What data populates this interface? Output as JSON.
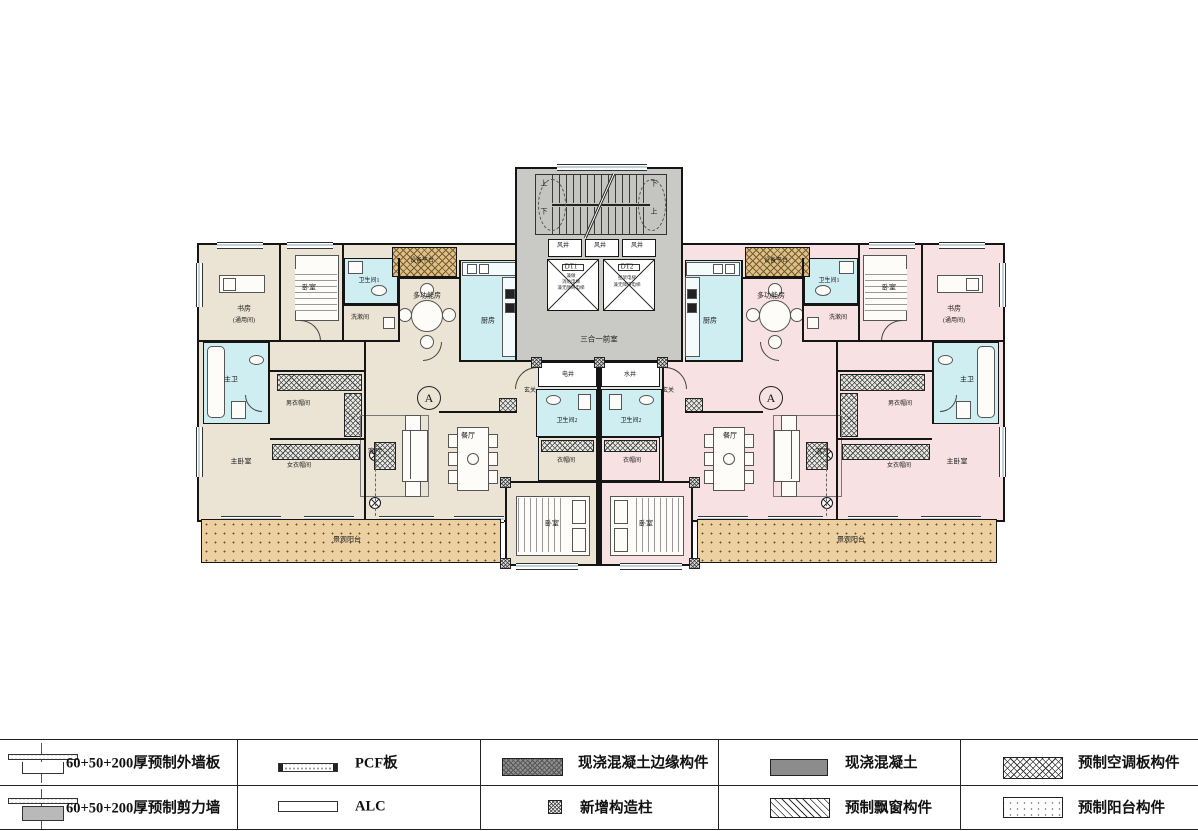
{
  "plan": {
    "marker_a": "A",
    "core": {
      "stair_up": "上",
      "stair_down": "下",
      "vent_shaft": "风井",
      "elevator1": "DT1",
      "elevator2": "DT2",
      "elevator1_note": [
        "兼做",
        "消防电梯",
        "兼无障碍电梯"
      ],
      "elevator2_note": [
        "担架电梯",
        "兼无障碍电梯"
      ],
      "lobby": "三合一前室",
      "electric_shaft": "电井",
      "water_shaft": "水井"
    },
    "rooms": {
      "study": "书房",
      "study_note": "(通用间)",
      "bedroom": "卧室",
      "bath1": "卫生间1",
      "laundry": "洗漱间",
      "multi_room": "多功能房",
      "kitchen": "厨房",
      "master_bath": "主卫",
      "mens_closet": "男衣帽间",
      "master_bedroom": "主卧室",
      "womens_closet": "女衣帽间",
      "living": "客厅",
      "dining": "餐厅",
      "foyer": "玄关",
      "bath2": "卫生间2",
      "closet": "衣帽间",
      "view_balcony": "景观阳台",
      "equipment_platform": "设备平台"
    }
  },
  "legend": {
    "items": [
      {
        "symbol": "precast-exterior-wall-panel",
        "label": "60+50+200厚预制外墙板"
      },
      {
        "symbol": "precast-shear-wall",
        "label": "60+50+200厚预制剪力墙"
      },
      {
        "symbol": "pcf-panel",
        "label": "PCF板"
      },
      {
        "symbol": "alc-panel",
        "label": "ALC"
      },
      {
        "symbol": "cast-in-place-edge-member",
        "label": "现浇混凝土边缘构件"
      },
      {
        "symbol": "new-structural-column",
        "label": "新增构造柱"
      },
      {
        "symbol": "cast-in-place-concrete",
        "label": "现浇混凝土"
      },
      {
        "symbol": "precast-bay-window",
        "label": "预制飘窗构件"
      },
      {
        "symbol": "precast-ac-panel",
        "label": "预制空调板构件"
      },
      {
        "symbol": "precast-balcony",
        "label": "预制阳台构件"
      }
    ]
  },
  "colors": {
    "beige": "#ebe4d4",
    "pink": "#f8e1e3",
    "core": "#c9c9c5",
    "wet": "#cfeef1",
    "balcony": "#ecd0a2",
    "equip": "#dcc08a",
    "wall": "#151515"
  }
}
